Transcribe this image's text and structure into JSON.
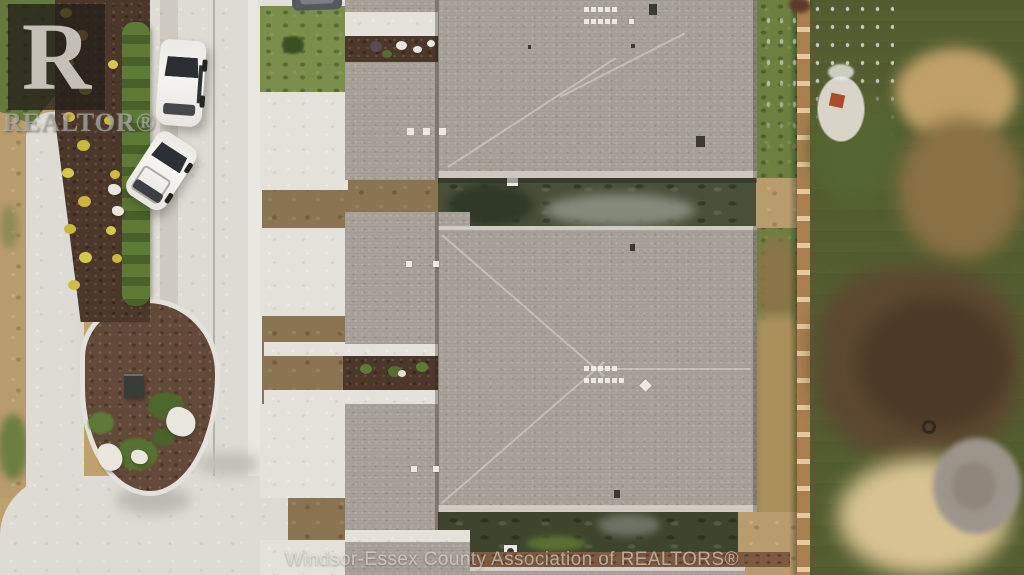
{
  "watermarks": {
    "logo_letter": "R",
    "logo_text": "REALTOR®",
    "footer_text": "Windsor-Essex County Association of REALTORS®"
  },
  "scene": {
    "type": "aerial-drone-photo-residential-construction",
    "palette": {
      "roof_shingle_gray": "#a8a199",
      "street_concrete": "#dedbd4",
      "driveway_concrete": "#e3e1da",
      "lawn_green": "#6d8040",
      "mulch_brown": "#4c382b",
      "island_mulch": "#62493a",
      "construction_dirt": "#b99c6d",
      "fence_wood": "#c29560",
      "hedge_green": "#5d7b34",
      "flower_yellow": "#d6c84c",
      "car_white": "#f5f4f1"
    }
  }
}
